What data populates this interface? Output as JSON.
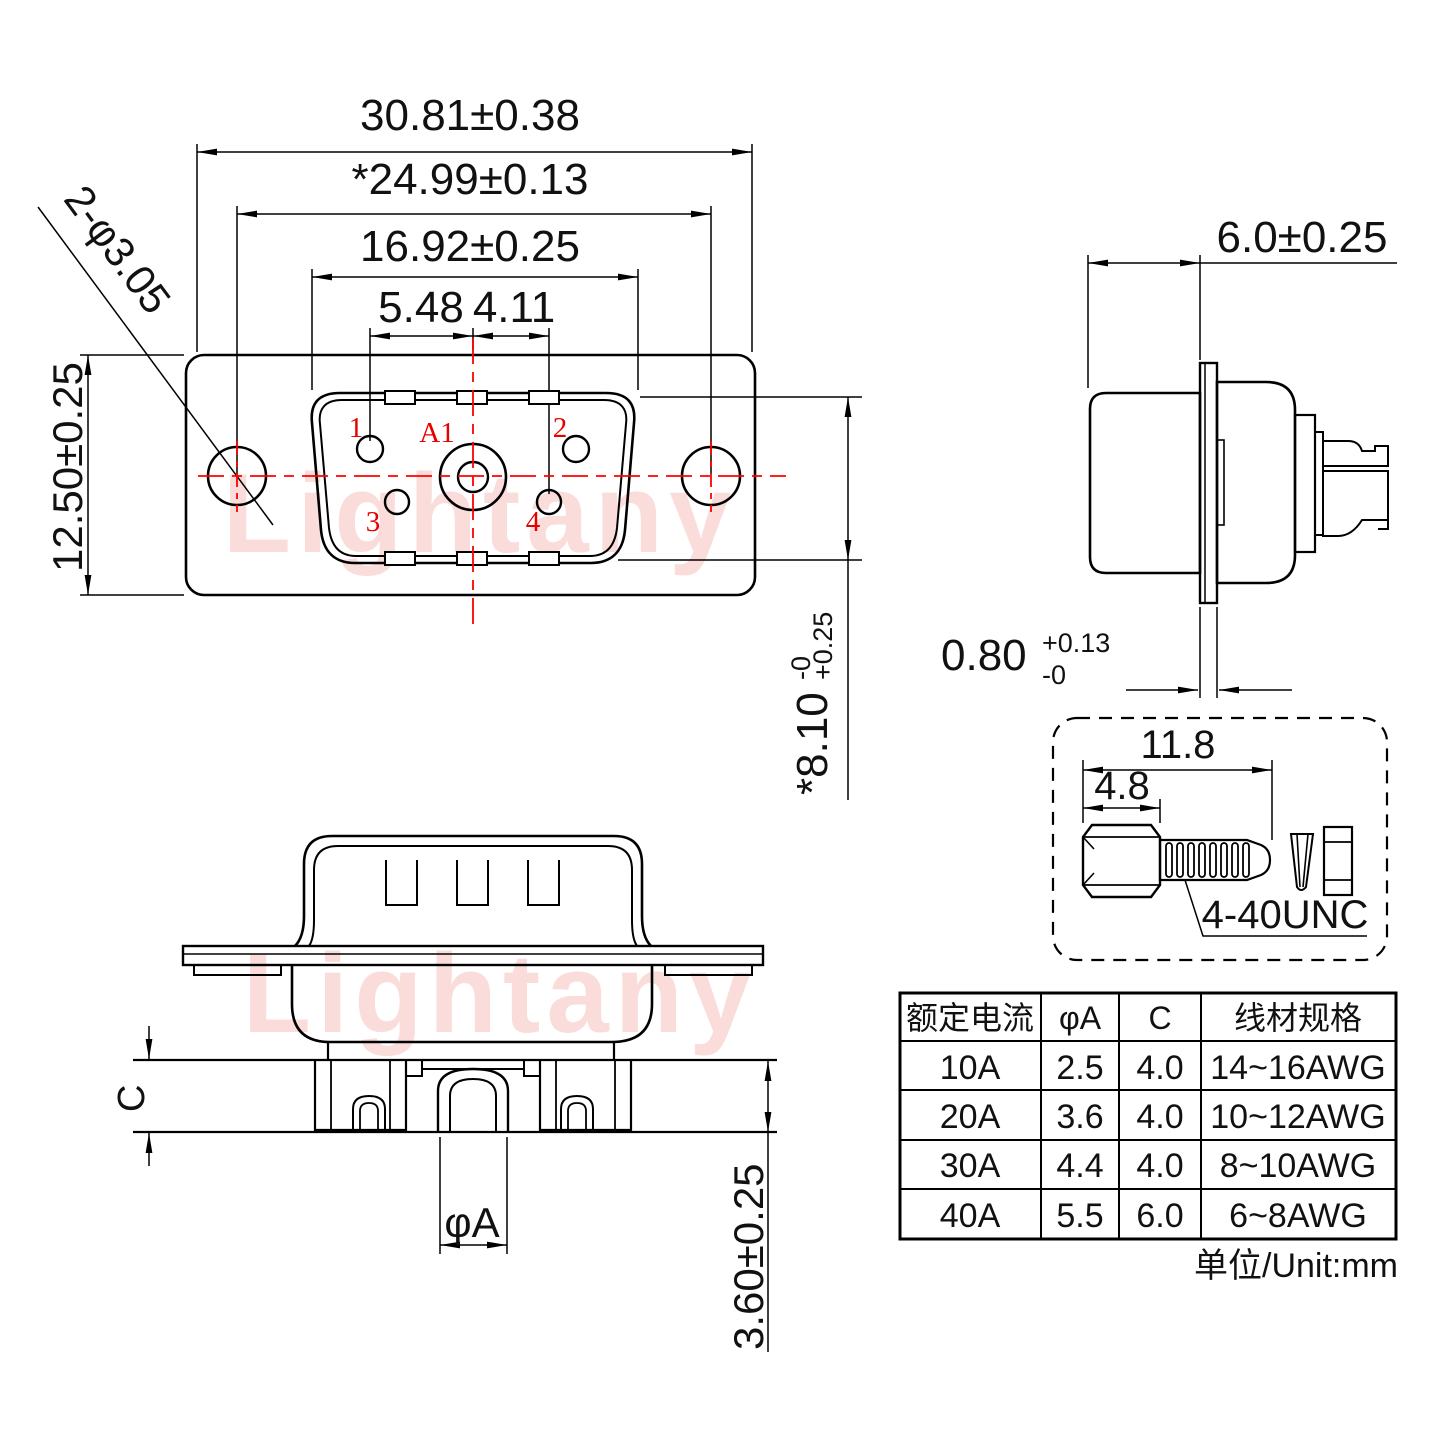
{
  "watermark": {
    "text": "Lightany"
  },
  "front_view": {
    "dim_width_outer": "30.81±0.38",
    "dim_width_mount": "*24.99±0.13",
    "dim_width_shell": "16.92±0.25",
    "dim_pin_left": "5.48",
    "dim_pin_right": "4.11",
    "dim_height": "12.50±0.25",
    "dim_holes": "2-φ3.05",
    "dim_shell_height_main": "*8.10",
    "dim_shell_height_tol_plus": "+0.25",
    "dim_shell_height_tol_minus": "-0",
    "pin_labels": {
      "p1": "1",
      "p2": "2",
      "p3": "3",
      "p4": "4",
      "a1": "A1"
    }
  },
  "side_view": {
    "dim_depth": "6.0±0.25",
    "dim_flange_main": "0.80",
    "dim_flange_tol_plus": "+0.13",
    "dim_flange_tol_minus": "-0"
  },
  "screw_detail": {
    "dim_length": "11.8",
    "dim_head": "4.8",
    "thread_label": "4-40UNC"
  },
  "bottom_view": {
    "dim_c": "C",
    "dim_phi_a": "φA",
    "dim_tail": "3.60±0.25"
  },
  "spec_table": {
    "headers": [
      "额定电流",
      "φA",
      "C",
      "线材规格"
    ],
    "rows": [
      {
        "current": "10A",
        "phi_a": "2.5",
        "c": "4.0",
        "wire": "14~16AWG"
      },
      {
        "current": "20A",
        "phi_a": "3.6",
        "c": "4.0",
        "wire": "10~12AWG"
      },
      {
        "current": "30A",
        "phi_a": "4.4",
        "c": "4.0",
        "wire": "8~10AWG"
      },
      {
        "current": "40A",
        "phi_a": "5.5",
        "c": "6.0",
        "wire": "6~8AWG"
      }
    ],
    "unit_note": "单位/Unit:mm"
  },
  "colors": {
    "line": "#000000",
    "accent_red": "#ff0000",
    "watermark_pink": "#e8564a"
  }
}
